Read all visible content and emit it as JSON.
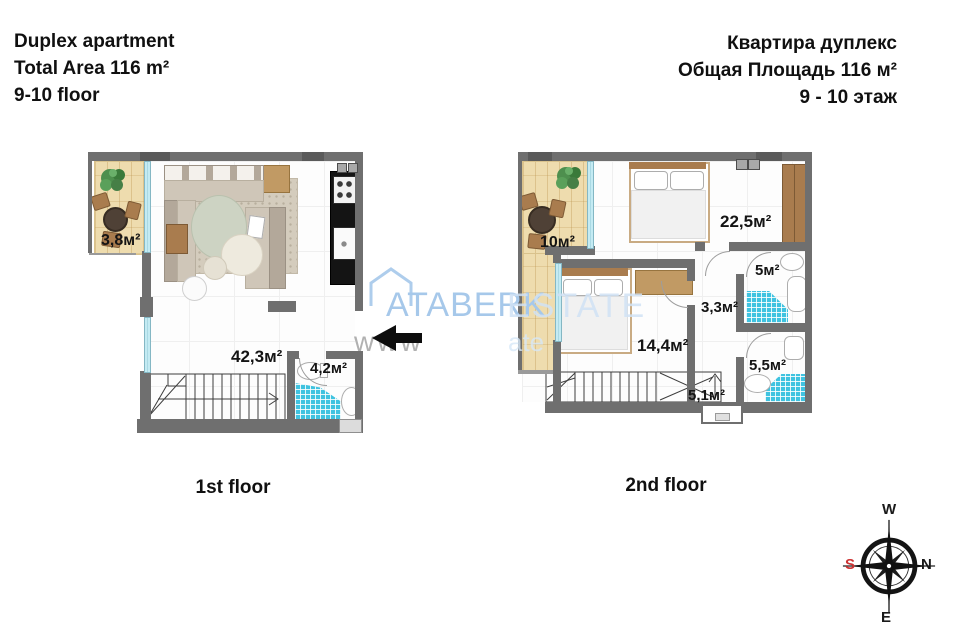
{
  "header": {
    "en_line1": "Duplex apartment",
    "en_line2": "Total Area 116 m²",
    "en_line3": "9-10 floor",
    "ru_line1": "Квартира дуплекс",
    "ru_line2": "Общая Площадь 116 м²",
    "ru_line3": "9 - 10 этаж"
  },
  "floor1": {
    "caption": "1st floor",
    "balcony_area": "3,8м²",
    "living_area": "42,3м²",
    "bathroom_area": "4,2м²"
  },
  "floor2": {
    "caption": "2nd floor",
    "balcony_area": "10м²",
    "bedroom1_area": "22,5м²",
    "bathroom1_area": "5м²",
    "hall_area": "3,3м²",
    "bedroom2_area": "14,4м²",
    "bathroom2_area": "5,5м²",
    "stairs_area": "5,1м²"
  },
  "watermark": {
    "brand_left": "ATABERK",
    "brand_right": "ESTATE",
    "url_left": "www",
    "url_right": "ate"
  },
  "compass": {
    "top": "W",
    "right": "N",
    "bottom": "E",
    "left": "S"
  },
  "colors": {
    "wall": "#6f6f6f",
    "window": "#c4ebf3",
    "tile_blue": "#3fc3e0",
    "wood_floor": "#eedcae",
    "wood_furniture": "#a97c4e",
    "watermark_blue": "#a6c8ea",
    "compass_south_red": "#cc3333"
  }
}
